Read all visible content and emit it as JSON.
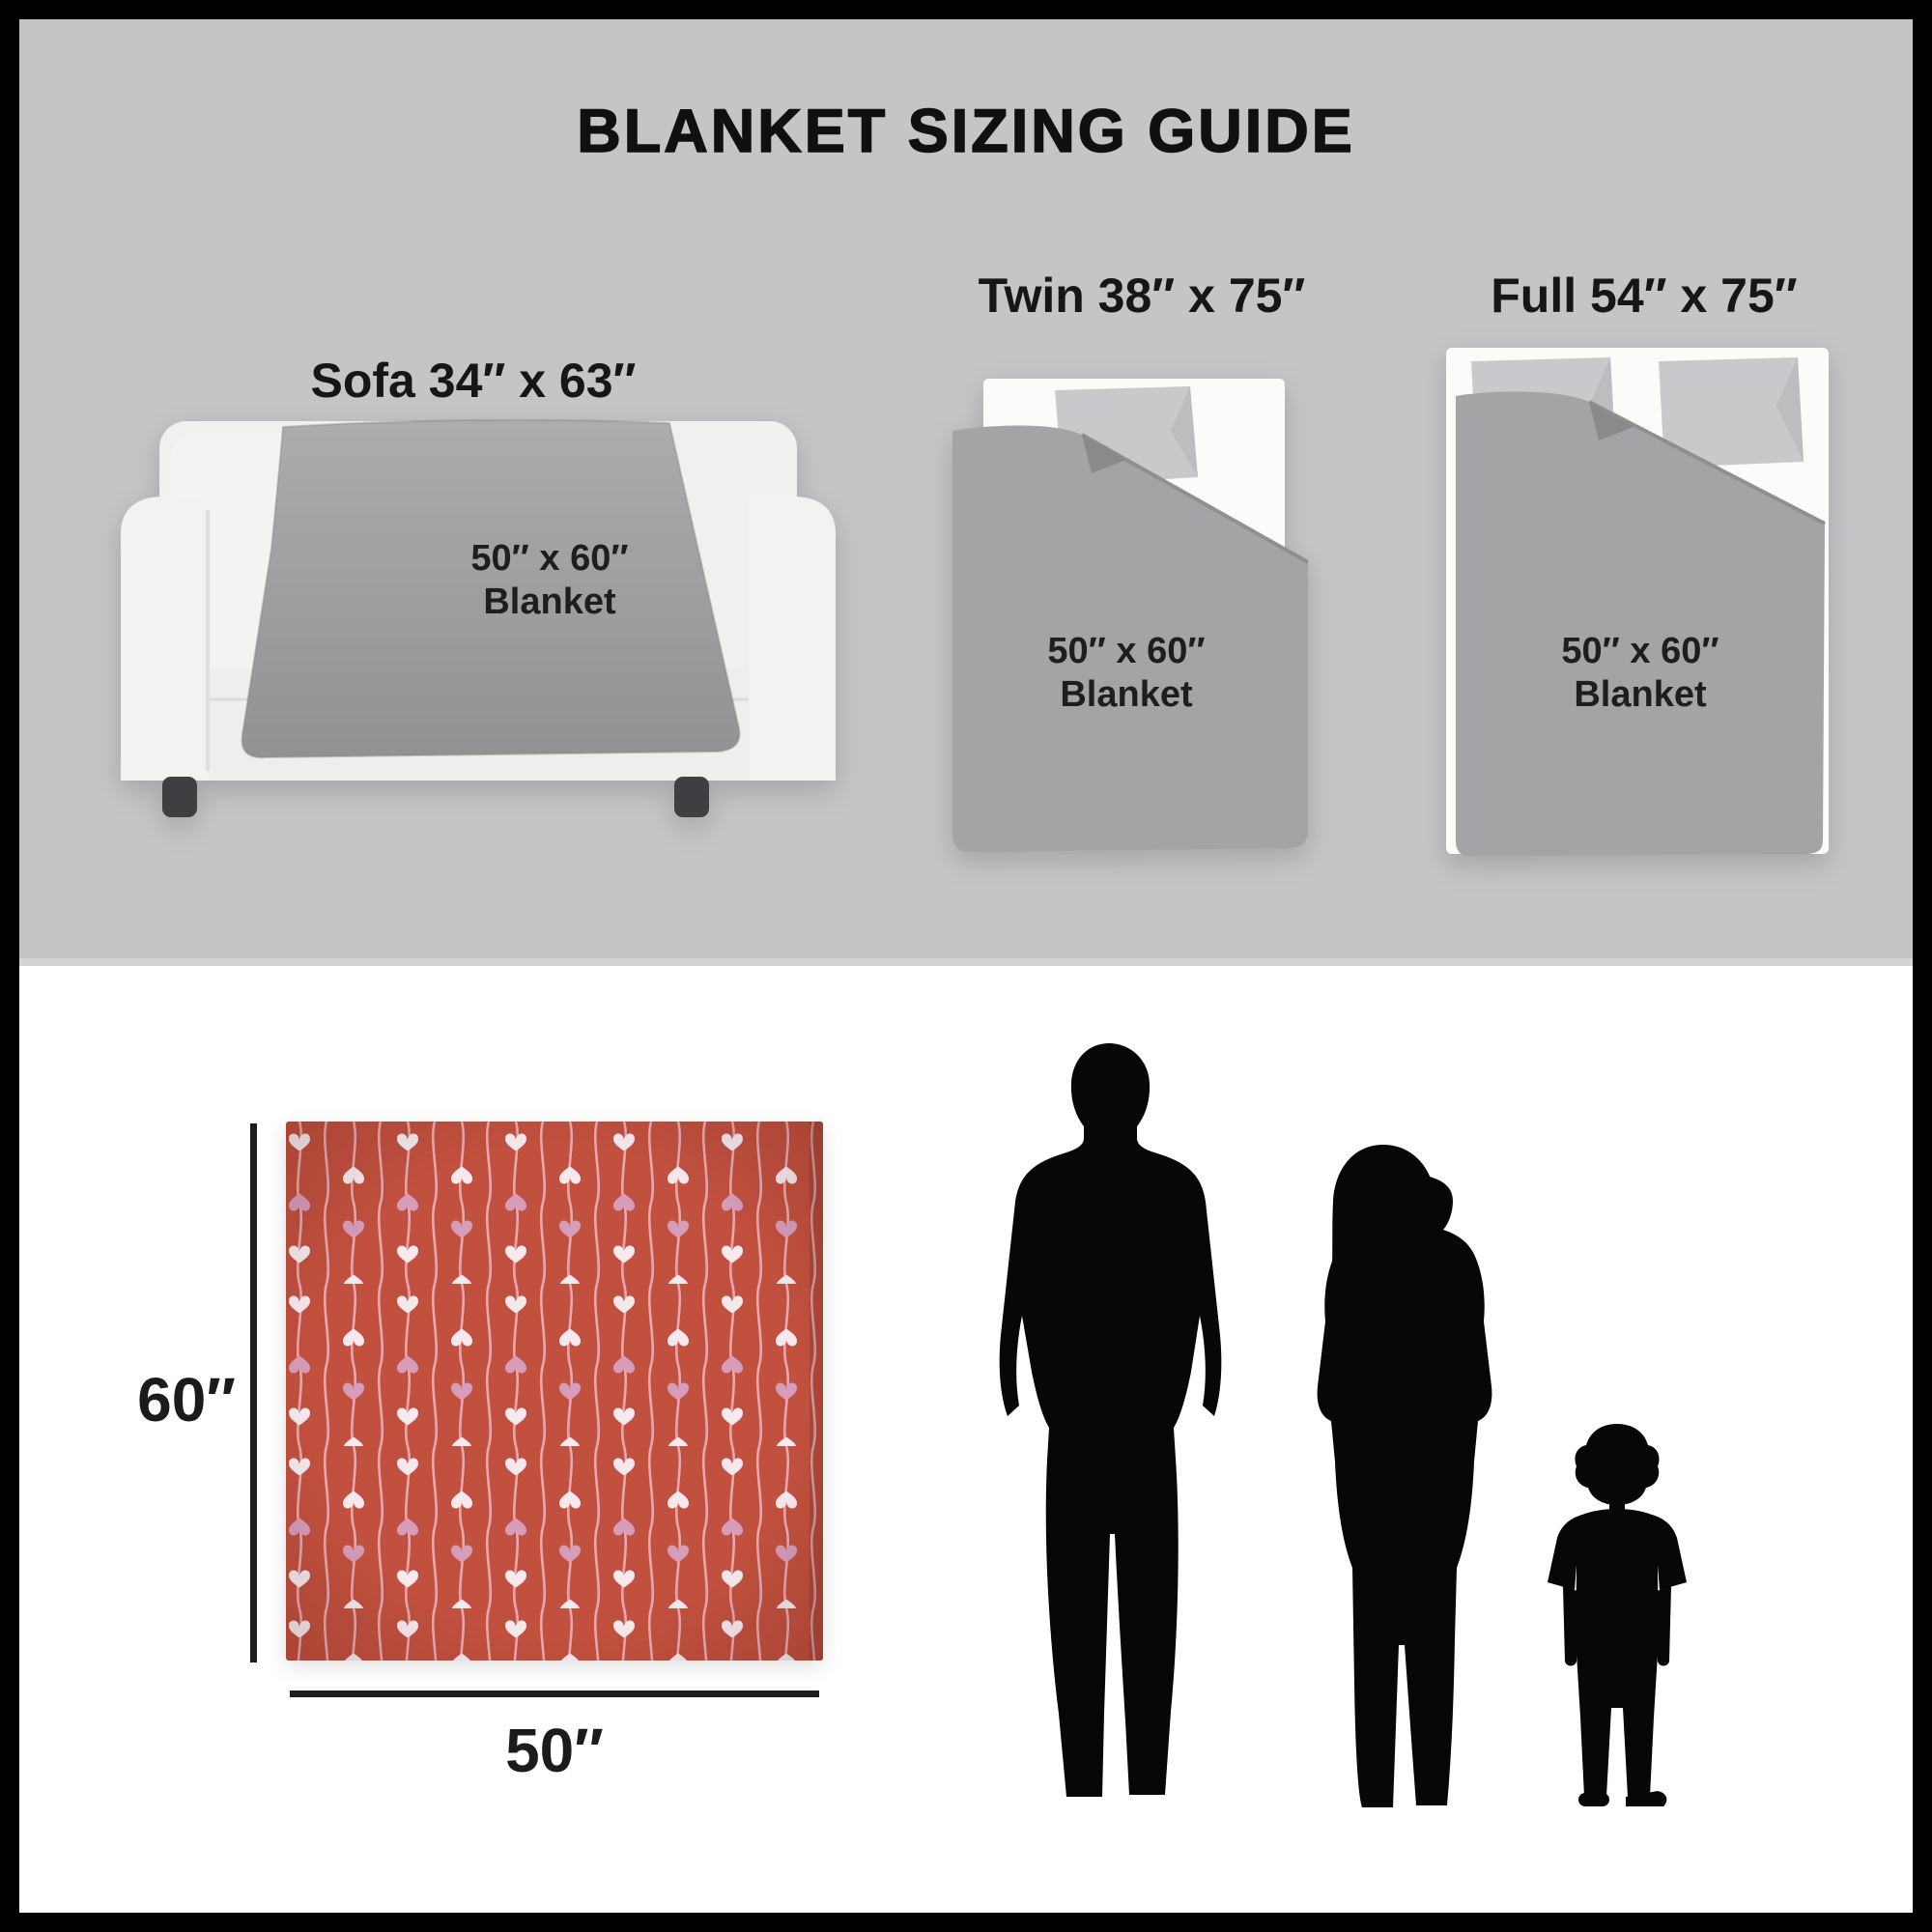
{
  "title": "BLANKET SIZING GUIDE",
  "sections": {
    "sofa": {
      "label": "Sofa 34″ x 63″",
      "blanket": {
        "line1": "50″ x 60″",
        "line2": "Blanket"
      }
    },
    "twin": {
      "label": "Twin 38″ x 75″",
      "blanket": {
        "line1": "50″ x 60″",
        "line2": "Blanket"
      }
    },
    "full": {
      "label": "Full 54″ x 75″",
      "blanket": {
        "line1": "50″ x 60″",
        "line2": "Blanket"
      }
    }
  },
  "size_diagram": {
    "height_label": "60″",
    "width_label": "50″"
  },
  "figures": {
    "left": "man-silhouette",
    "middle": "woman-silhouette",
    "right": "child-silhouette"
  },
  "colors": {
    "top_background": "#c5c5c7",
    "bottom_background": "#ffffff",
    "frame": "#000000",
    "blanket_gray": "#a4a4a6",
    "sofa_fabric": "#f1f0ee",
    "pillow_gray": "#c9c9cb",
    "sheet_white": "#fbfbfa",
    "blanket_red": "#c2503e",
    "heart_white": "#f6e9ee",
    "heart_pink": "#d69cba",
    "wave_line": "#ecb6c3",
    "silhouette": "#070707"
  }
}
